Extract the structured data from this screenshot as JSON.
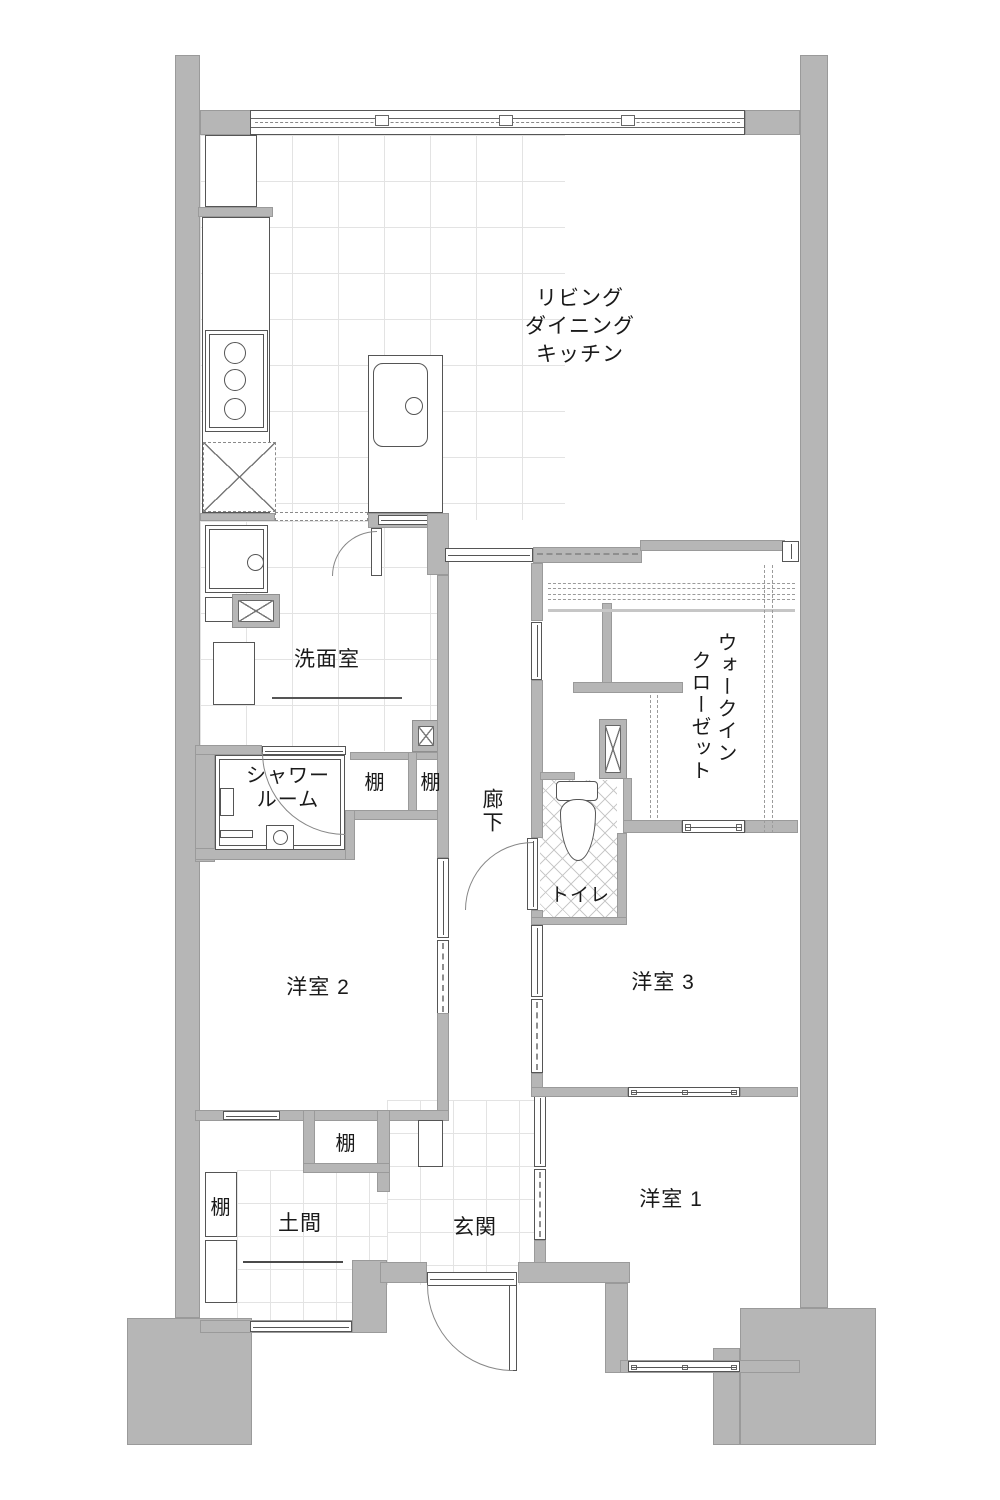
{
  "plan_title": "apartment-floor-plan",
  "labels": {
    "ldk_line1": "リビング",
    "ldk_line2": "ダイニング",
    "ldk_line3": "キッチン",
    "washroom": "洗面室",
    "shower_line1": "シャワー",
    "shower_line2": "ルーム",
    "shelf": "棚",
    "corridor": "廊下",
    "wic_line1": "ウォークイン",
    "wic_line2": "クローゼット",
    "toilet": "トイレ",
    "room2": "洋室 2",
    "room3": "洋室 3",
    "room1": "洋室 1",
    "doma": "土間",
    "genkan": "玄関"
  },
  "colors": {
    "wall": "#b6b6b6",
    "wall_edge": "#9a9a9a",
    "line": "#555555",
    "arc": "#878787",
    "tile_line": "#e3e3e3",
    "text": "#1a1a1a"
  }
}
